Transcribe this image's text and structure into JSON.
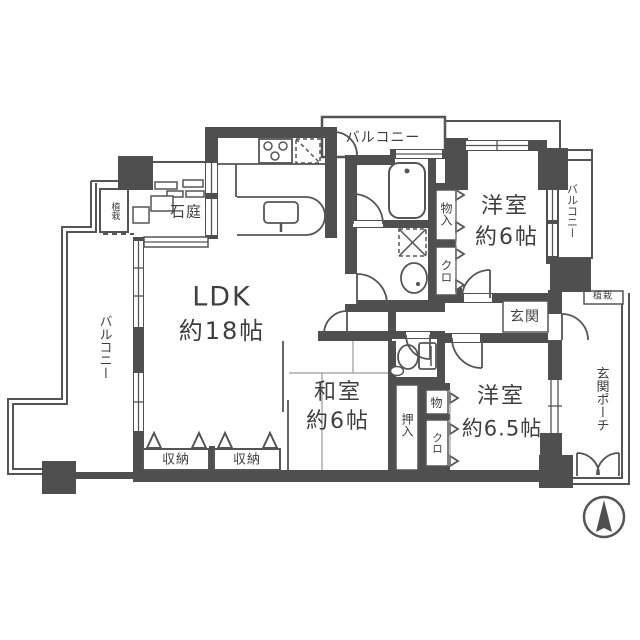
{
  "meta": {
    "type": "apartment-floor-plan",
    "colors": {
      "wall": "#4f4f4f",
      "line": "#555555",
      "text": "#3f3f3f",
      "background": "#ffffff"
    }
  },
  "labels": {
    "ldk_name": "LDK",
    "ldk_size": "約18帖",
    "washitsu_name": "和室",
    "washitsu_size": "約6帖",
    "yoshitsu1_name": "洋室",
    "yoshitsu1_size": "約6帖",
    "yoshitsu2_name": "洋室",
    "yoshitsu2_size": "約6.5帖",
    "balcony_top": "バルコニー",
    "balcony_left": "バルコニー",
    "balcony_right": "バルコニー",
    "rock_garden": "石庭",
    "planting_left": "植栽",
    "planting_right": "植栽",
    "entrance": "玄関",
    "entrance_porch": "玄関ポーチ",
    "storage_1": "収納",
    "storage_2": "収納",
    "oshiire": "押入",
    "monoire_upper": "物入",
    "closet_upper": "クロ",
    "mono_lower": "物",
    "closet_lower": "クロ"
  }
}
